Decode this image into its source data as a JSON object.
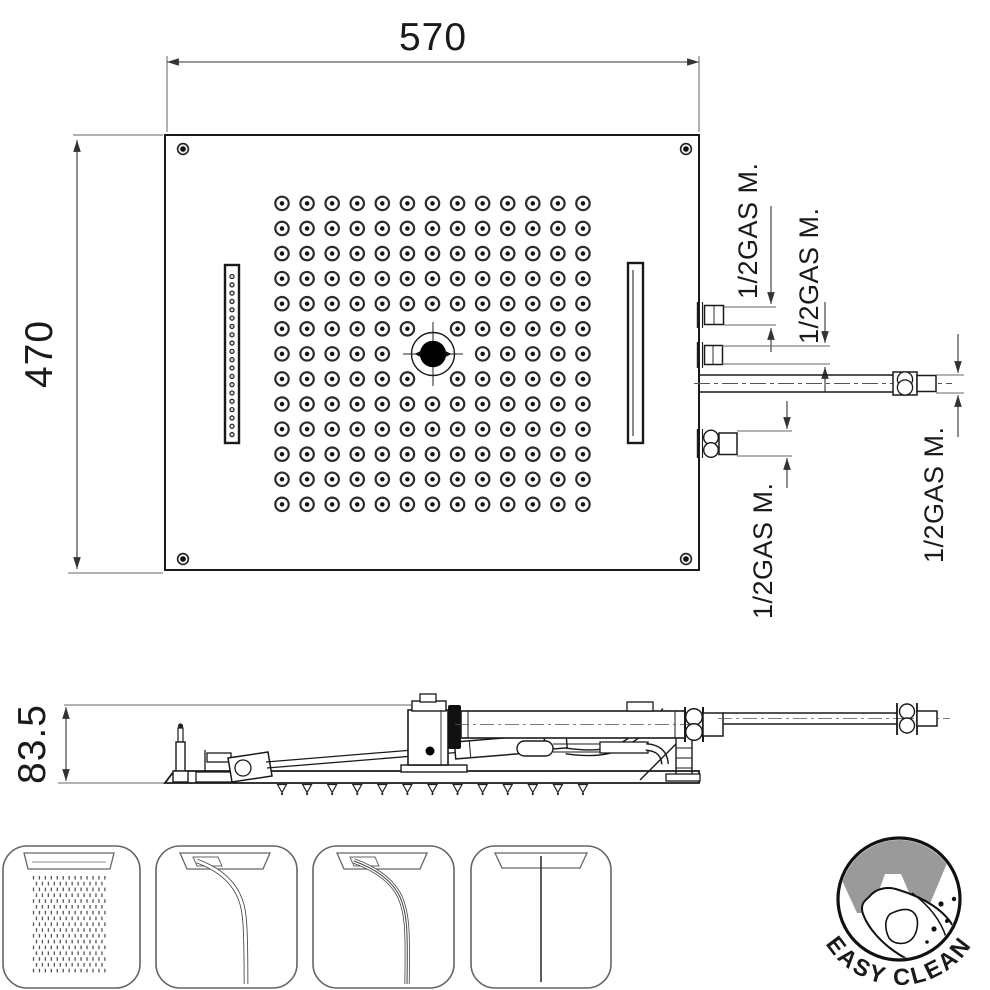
{
  "dimensions": {
    "width": "570",
    "height": "470",
    "side_height": "83.5"
  },
  "connection_labels": [
    "1/2GAS M.",
    "1/2GAS M.",
    "1/2GAS M.",
    "1/2GAS M."
  ],
  "badge": {
    "label": "EASY CLEAN"
  },
  "colors": {
    "line": "#1a1a1a",
    "thin_line": "#666666",
    "badge_gray": "#9a9a9a",
    "background": "#ffffff"
  },
  "generators": {
    "nozzle_grid": {
      "cols": 13,
      "rows": 13,
      "x0": 282,
      "y0": 203.4,
      "dx": 25.08,
      "dy": 25.08
    },
    "corner_screws": [
      [
        183,
        149
      ],
      [
        686,
        149
      ],
      [
        183,
        559
      ],
      [
        686,
        559
      ]
    ],
    "slot_holes": {
      "count": 20,
      "x": 232,
      "y0": 276.5,
      "dy": 8.32
    },
    "side_teeth": {
      "count": 13,
      "x0": 282,
      "dx": 25.08,
      "y": 783.5
    },
    "rain": {
      "cols": 13,
      "rows": 17,
      "x0": 33.5,
      "y0": 876,
      "dx": 5.95,
      "dy": 5.8
    }
  }
}
